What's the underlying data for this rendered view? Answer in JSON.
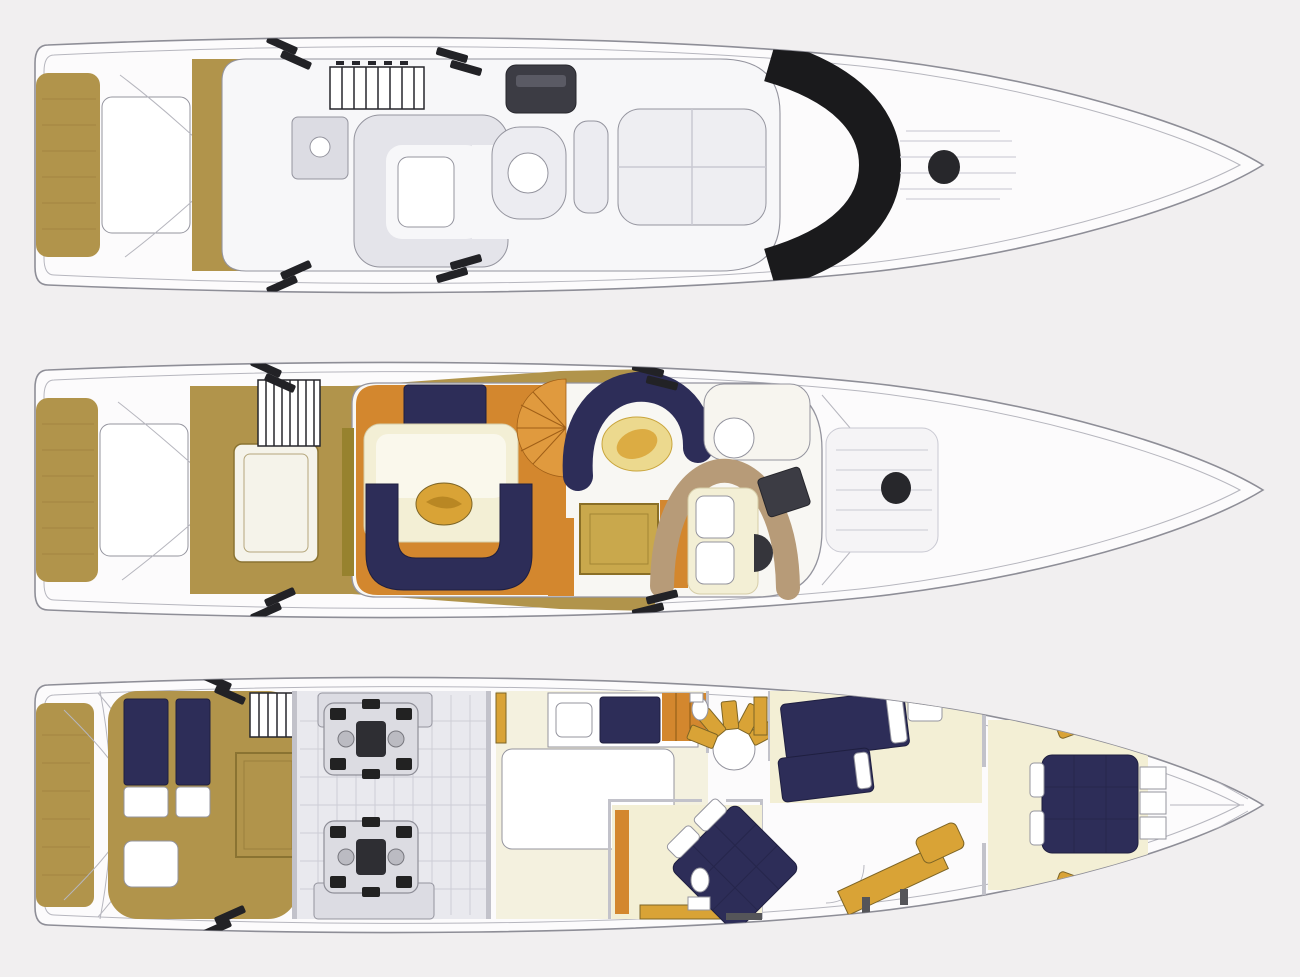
{
  "meta": {
    "title": "Motor yacht three-deck floor plan (top view, bow to the right)",
    "diagram_type": "yacht-deck-plan",
    "deck_count": 3
  },
  "palette": {
    "background": "#f1eff0",
    "hull_fill": "#fcfbfc",
    "hull_line": "#8e8e97",
    "inner_line": "#b6b6be",
    "teak": "#b1944b",
    "teak_line": "#97793a",
    "navy": "#2d2d58",
    "navy_dark": "#1f1f40",
    "orange": "#d3872e",
    "orange_light": "#e09a3e",
    "cream": "#f3efd5",
    "gold": "#d9a336",
    "gold_pale": "#ecd98e",
    "olive": "#97822e",
    "tan": "#b79b78",
    "gray_fill": "#dcdce3",
    "gray_line": "#94949e",
    "dark": "#222226",
    "engine_floor": "#e9e9ee",
    "grid_line": "#c9c9d2"
  },
  "decks": [
    {
      "id": "flybridge",
      "name": "flybridge-and-foredeck",
      "features": [
        "swim-platform-teak",
        "transom-stair-hatch",
        "teak-transom-deck",
        "boarding-step-stripes",
        "flybridge-grill",
        "wet-bar-unit",
        "u-shaped-settee",
        "cocktail-table",
        "helm-console",
        "helm-seat",
        "companion-bench",
        "sun-pad",
        "black-windscreen-arch",
        "foredeck-sun-pad-lines",
        "foredeck-hatch"
      ]
    },
    {
      "id": "main-deck",
      "name": "main-deck",
      "features": [
        "swim-platform-teak",
        "transom-stair-hatch",
        "teak-cockpit",
        "engine-room-hatch",
        "flybridge-ladder",
        "side-deck-step-stripes",
        "salon-forward-bench",
        "salon-table-with-gold-tray",
        "u-shaped-salon-sofa",
        "sideboard",
        "galley-staircase-fan",
        "dinette-horseshoe-sofa",
        "dinette-oval-table",
        "chart-table",
        "helm-settee",
        "companion-seat",
        "helm-console",
        "steering-wheel",
        "foredeck-sun-pad",
        "foredeck-hatch"
      ]
    },
    {
      "id": "lower-deck",
      "name": "lower-deck",
      "features": [
        "swim-platform-teak",
        "crew-cabin-twin-bunks",
        "crew-table",
        "deck-hatch-outline",
        "crew-ladder",
        "engine-room-twin-engines",
        "aft-guest-cabin-berth",
        "wardrobe",
        "spiral-staircase",
        "shower-head-fixtures",
        "master-cabin-diamond-double-berth",
        "master-wardrobes",
        "dressing-vanity",
        "twin-guest-cabin-berths",
        "nightstand",
        "vip-forward-cabin-double-berth",
        "vip-side-cabinets",
        "vip-steps",
        "bow-locker-lines",
        "mooring-cleat-marks"
      ]
    }
  ]
}
